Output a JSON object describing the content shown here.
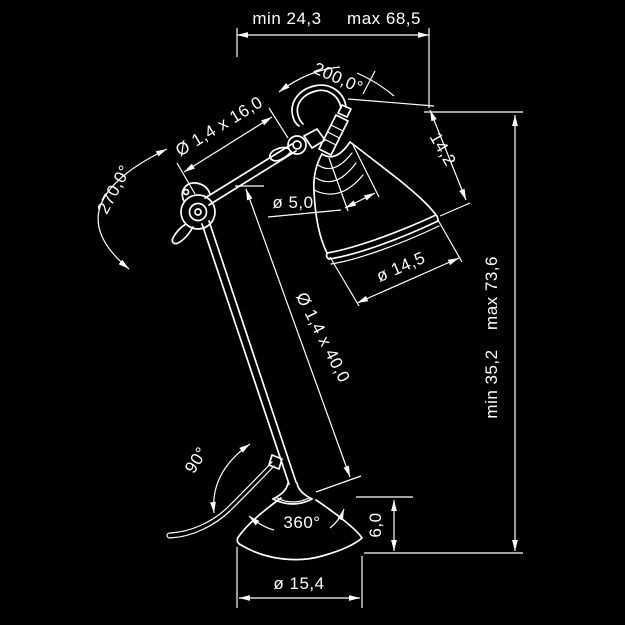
{
  "drawing": {
    "kind": "technical dimension drawing",
    "subject": "articulated desk lamp (arm lamp) with shade and round base",
    "background_color": "#000000",
    "line_color": "#ffffff"
  },
  "dims": {
    "top_min": "min 24,3",
    "top_max": "max 68,5",
    "head_swivel": "200,0°",
    "upper_arm": "Ø 1,4 x 16,0",
    "elbow_swivel": "270,0°",
    "head_depth": "14,2",
    "shade_neck": "ø 5,0",
    "shade_diameter": "ø 14,5",
    "lower_arm": "Ø 1,4 x 40,0",
    "height_min": "min 35,2",
    "height_max": "max 73,6",
    "arm_pivot": "90°",
    "base_swivel": "360°",
    "base_height": "6,0",
    "base_diameter": "ø 15,4"
  }
}
